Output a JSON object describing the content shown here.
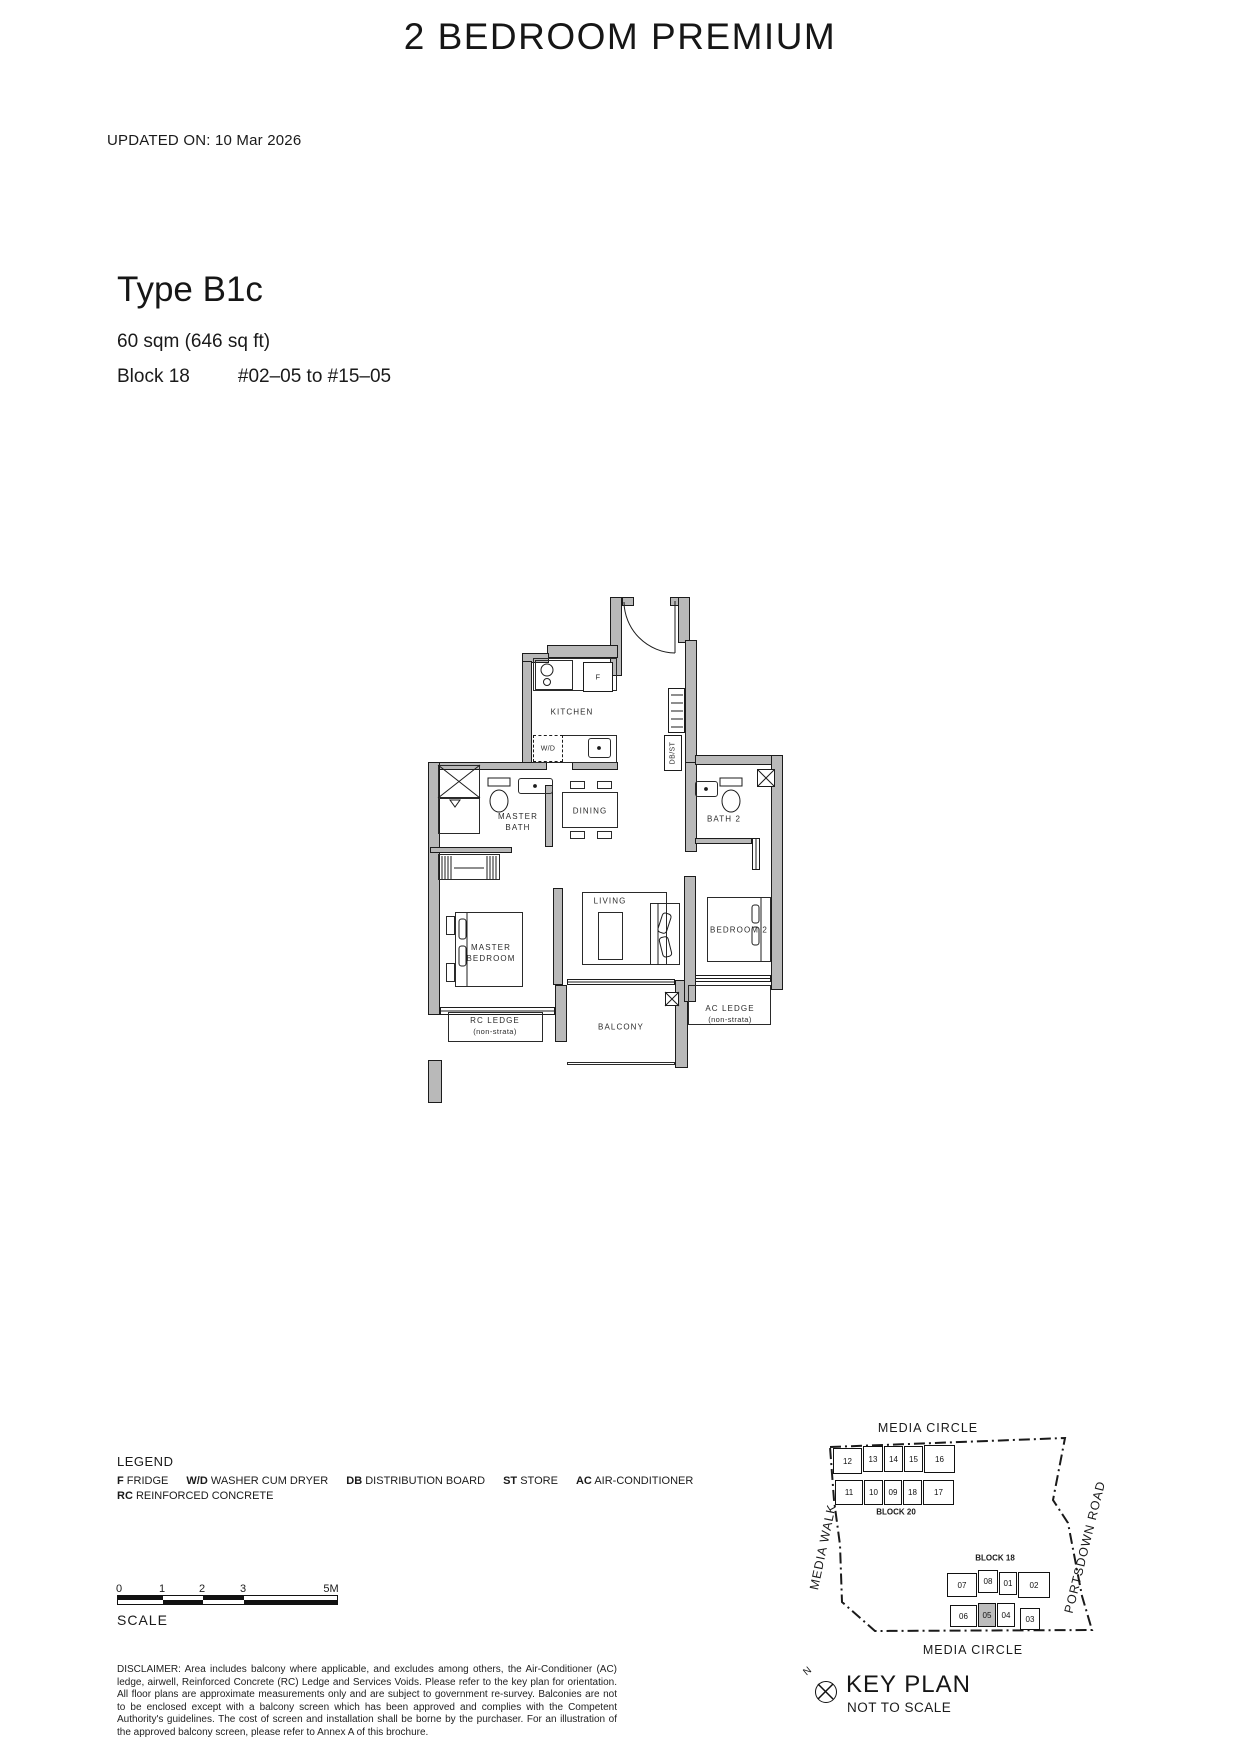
{
  "header": {
    "title": "2 BEDROOM PREMIUM",
    "updated_on": "UPDATED ON: 10 Mar 2026"
  },
  "unit": {
    "type_name": "Type B1c",
    "area": "60 sqm (646 sq ft)",
    "block": "Block 18",
    "units_range": "#02–05 to #15–05"
  },
  "floorplan": {
    "labels": {
      "kitchen": "KITCHEN",
      "dining": "DINING",
      "master_bath": [
        "MASTER",
        "BATH"
      ],
      "bath2": "BATH 2",
      "living": "LIVING",
      "master_bedroom": [
        "MASTER",
        "BEDROOM"
      ],
      "bedroom2": "BEDROOM 2",
      "balcony": "BALCONY",
      "rc_ledge": [
        "RC LEDGE",
        "(non-strata)"
      ],
      "ac_ledge": [
        "AC LEDGE",
        "(non-strata)"
      ],
      "fridge": "F",
      "washer": "W/D",
      "dbst": "DB/ST"
    }
  },
  "legend": {
    "heading": "LEGEND",
    "items": [
      {
        "abbr": "F",
        "desc": "FRIDGE"
      },
      {
        "abbr": "W/D",
        "desc": "WASHER CUM DRYER"
      },
      {
        "abbr": "DB",
        "desc": "DISTRIBUTION BOARD"
      },
      {
        "abbr": "ST",
        "desc": "STORE"
      },
      {
        "abbr": "AC",
        "desc": "AIR-CONDITIONER"
      },
      {
        "abbr": "RC",
        "desc": "REINFORCED CONCRETE"
      }
    ]
  },
  "scalebar": {
    "ticks": [
      "0",
      "1",
      "2",
      "3",
      "5M"
    ],
    "label": "SCALE"
  },
  "disclaimer": "DISCLAIMER: Area includes balcony where applicable, and excludes among others, the Air-Conditioner (AC) ledge, airwell, Reinforced Concrete (RC) Ledge and Services Voids. Please refer to the key plan for orientation. All floor plans are approximate measurements only and are subject to government re-survey. Balconies are not to be enclosed except with a balcony screen which has been approved and complies with the Competent Authority's guidelines. The cost of screen and installation shall be borne by the purchaser. For an illustration of the approved balcony screen, please refer to Annex A of this brochure.",
  "keyplan": {
    "title": "KEY PLAN",
    "subtitle": "NOT TO SCALE",
    "north_label": "N",
    "road_top": "MEDIA CIRCLE",
    "road_bottom": "MEDIA CIRCLE",
    "road_left": "MEDIA WALK",
    "road_right": "PORTSDOWN ROAD",
    "block20": {
      "label": "BLOCK 20",
      "units_top": [
        "12",
        "13",
        "14",
        "15",
        "16"
      ],
      "units_bottom": [
        "11",
        "10",
        "09",
        "18",
        "17"
      ]
    },
    "block18": {
      "label": "BLOCK 18",
      "units_top": [
        "07",
        "08",
        "01",
        "02"
      ],
      "units_bottom": [
        "06",
        "05",
        "04",
        "03"
      ],
      "highlighted_unit": "05"
    }
  }
}
